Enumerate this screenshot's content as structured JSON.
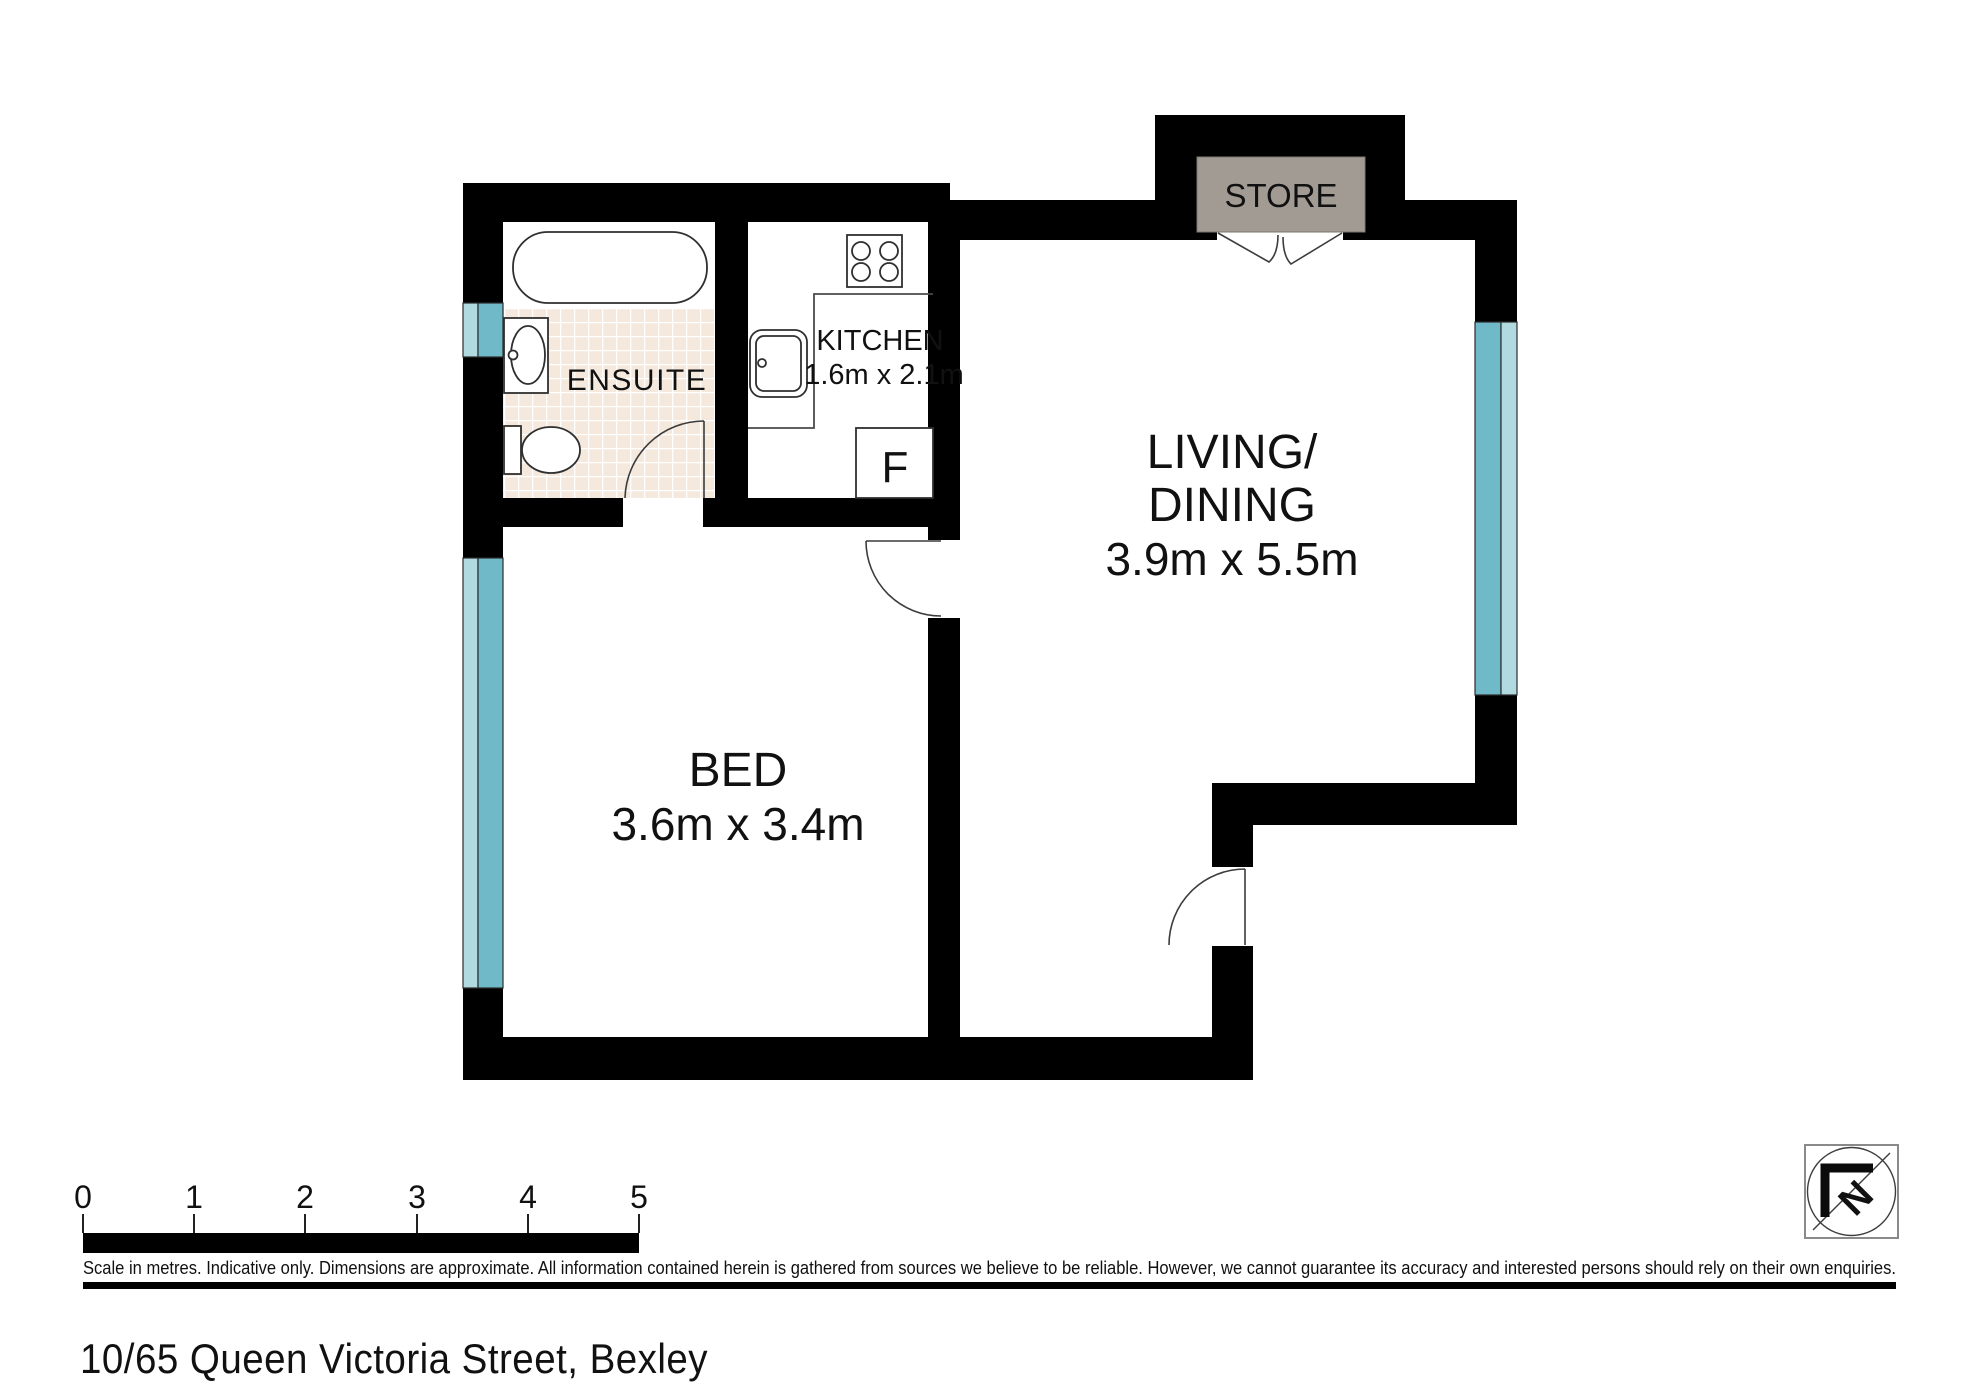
{
  "address": "10/65 Queen Victoria Street, Bexley",
  "rooms": {
    "ensuite": {
      "label": "ENSUITE"
    },
    "kitchen": {
      "label": "KITCHEN",
      "dims": "1.6m x 2.1m"
    },
    "living": {
      "label_line1": "LIVING/",
      "label_line2": "DINING",
      "dims": "3.9m x 5.5m"
    },
    "bed": {
      "label": "BED",
      "dims": "3.6m x 3.4m"
    },
    "store": {
      "label": "STORE"
    }
  },
  "fixtures": {
    "fridge_label": "F"
  },
  "compass": {
    "north_label": "N"
  },
  "scale_bar": {
    "labels": [
      "0",
      "1",
      "2",
      "3",
      "4",
      "5"
    ]
  },
  "footer": {
    "disclaimer": "Scale in metres. Indicative only. Dimensions are approximate. All information contained herein is gathered from sources we believe to be reliable. However, we cannot guarantee its accuracy and interested persons should rely on their own enquiries."
  },
  "colors": {
    "wall": "#000000",
    "window_dark": "#6fb9c9",
    "window_light": "#b0d9e0",
    "store_fill": "#a29b94",
    "tile": "#f5e8dc"
  }
}
